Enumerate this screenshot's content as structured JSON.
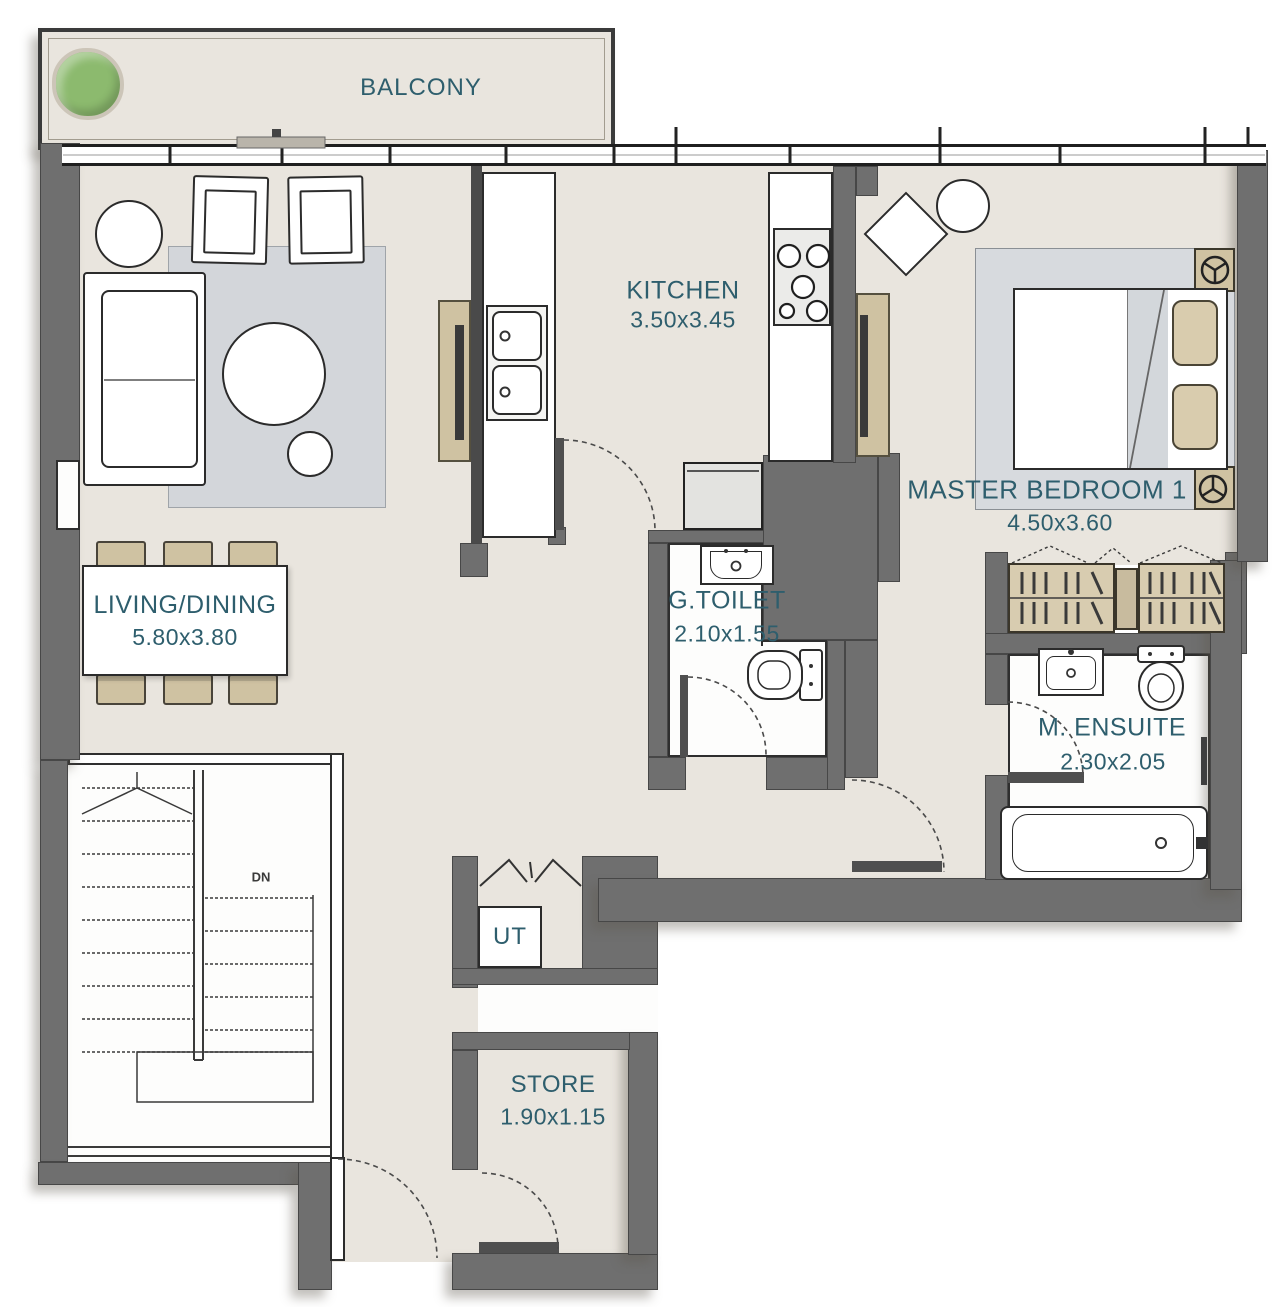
{
  "colors": {
    "wall": "#6f6f6f",
    "floor": "#e9e5de",
    "accent": "#2e5e6d",
    "tan": "#cfc2a2",
    "rug": "#d3d6da",
    "plant": "#8cba6e",
    "white-room": "#fdfdfc"
  },
  "rooms": {
    "balcony": {
      "label": "BALCONY"
    },
    "kitchen": {
      "label": "KITCHEN",
      "dims": "3.50x3.45"
    },
    "master_bedroom": {
      "label": "MASTER BEDROOM 1",
      "dims": "4.50x3.60"
    },
    "living_dining": {
      "label": "LIVING/DINING",
      "dims": "5.80x3.80"
    },
    "guest_toilet": {
      "label": "G.TOILET",
      "dims": "2.10x1.55"
    },
    "ensuite": {
      "label": "M. ENSUITE",
      "dims": "2.30x2.05"
    },
    "utility": {
      "label": "UT"
    },
    "store": {
      "label": "STORE",
      "dims": "1.90x1.15"
    },
    "stairs": {
      "label": "DN"
    }
  }
}
